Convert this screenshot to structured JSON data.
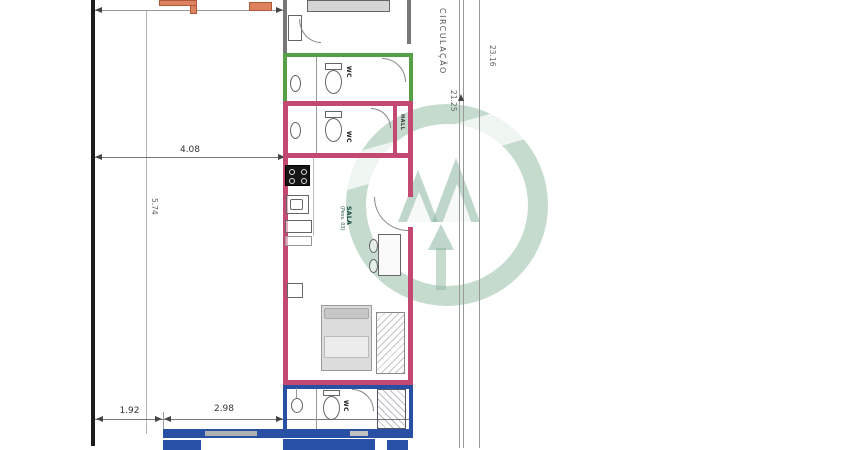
{
  "document": {
    "kind": "architectural floor plan",
    "language": "pt-BR"
  },
  "colors": {
    "wall_orange": "#dc825f",
    "wall_green": "#55a046",
    "wall_magenta": "#c44970",
    "wall_blue": "#2850a5",
    "line_dark": "#1c1c1c",
    "line_gray": "#8a8a8a",
    "watermark_green": "#8ab79e",
    "text_dark": "#333333",
    "text_gray": "#666666"
  },
  "dimensions": {
    "width_top": "4.08",
    "height_left": "5.74",
    "bottom_left": "1.92",
    "bottom_right": "2.98",
    "right_inner": "21.25",
    "right_outer": "23.16"
  },
  "labels": {
    "circulation": "CIRCULAÇÃO",
    "wc_green": "WC",
    "wc_pink": "WC",
    "wc_blue": "WC",
    "living": "SALA",
    "living_sub": "(Pess. 03)",
    "hall": "HALL"
  },
  "rooms": [
    {
      "name": "bedroom-top-partial",
      "outline": "#dc825f"
    },
    {
      "name": "wc-upper",
      "outline": "#55a046",
      "label": "WC"
    },
    {
      "name": "wc-middle",
      "outline": "#c44970",
      "label": "WC"
    },
    {
      "name": "hall",
      "outline": "#c44970",
      "label": "HALL"
    },
    {
      "name": "sala-kitchen",
      "outline": "#c44970",
      "label": "SALA (Pess. 03)"
    },
    {
      "name": "bedroom-lower",
      "outline": "#c44970"
    },
    {
      "name": "wc-bottom",
      "outline": "#2850a5",
      "label": "WC"
    },
    {
      "name": "corridor",
      "label": "CIRCULAÇÃO"
    }
  ]
}
